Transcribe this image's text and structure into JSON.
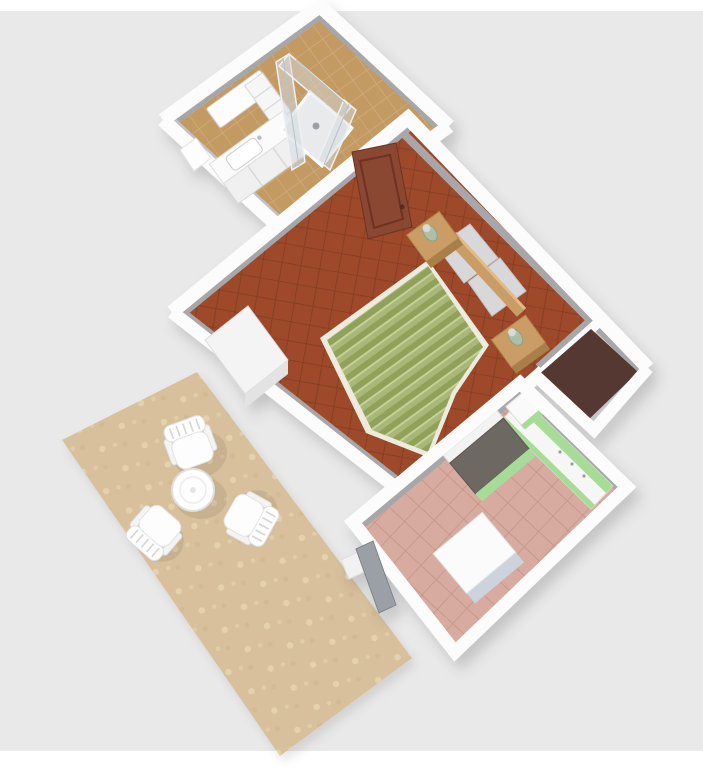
{
  "scene": {
    "kind": "3d-floor-plan-render",
    "view": "rotated top-down isometric view of a small apartment",
    "visible_text": "",
    "rooms": [
      {
        "id": "bathroom",
        "position": "top",
        "furniture": [
          "vanity-with-sink",
          "mirror",
          "storage-shelf",
          "glass-shower-enclosure",
          "window-recess"
        ]
      },
      {
        "id": "bedroom",
        "position": "center",
        "furniture": [
          "double-bed-green-striped-duvet",
          "two-pillows",
          "wooden-headboard",
          "nightstand-with-lamp",
          "nightstand-with-lamp",
          "white-cabinet",
          "brown-interior-door"
        ]
      },
      {
        "id": "storage-alcove",
        "position": "right",
        "furniture": []
      },
      {
        "id": "kitchen",
        "position": "bottom-right",
        "furniture": [
          "green-counter-along-wall",
          "cooktop-unit",
          "tall-corner-unit",
          "white-table",
          "service-door"
        ]
      },
      {
        "id": "terrace",
        "position": "bottom-left",
        "furniture": [
          "round-garden-table",
          "garden-chair",
          "garden-chair",
          "garden-chair"
        ]
      }
    ]
  },
  "colors": {
    "bg": "#e9e9ea",
    "strip": "#ffffff",
    "wall": "#fcfcfc",
    "wall_face": "#a7a7a9",
    "wall_face_light": "#c2c2c4",
    "bathroom_floor": "#c39a62",
    "bedroom_floor": "#9d4a2b",
    "brown_floor": "#553931",
    "kitchen_floor": "#d7aba0",
    "terrace": "#d8c09c",
    "terrace_speckle": "#e4cfa9",
    "duvet": "#a9b878",
    "duvet_stripe": "#8b9c54",
    "mattress": "#ecebdd",
    "pillow": "#d8d8da",
    "pillow_edge": "#c2c2c6",
    "wood": "#cb9d66",
    "wood_dark": "#a87e48",
    "door": "#8a4632",
    "door_panel": "#6d3322",
    "cabinet_green": "#a6dc98",
    "appliance": "#6e6762",
    "white_furniture": "#fbfbfb",
    "furniture_edge": "#e2e2e2",
    "table_face": "#ccd3dd",
    "glass": "#d3dade",
    "shower_tray": "#e8eaec",
    "gray_door": "#9aa0a5",
    "lamp": "#aebfa8"
  }
}
